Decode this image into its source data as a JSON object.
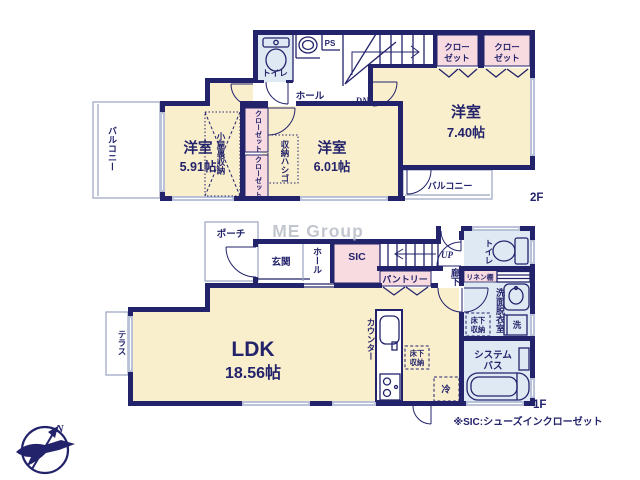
{
  "colors": {
    "wall_navy": "#23236b",
    "room_cream": "#faefcd",
    "wet_blue": "#dfe9f4",
    "closet_pink": "#f8dbe0",
    "window_gray": "#b9c2d8",
    "watermark_gray": "#b4b8c2"
  },
  "watermark": "ME Group",
  "note": "※SIC:シューズインクローゼット",
  "compass": {
    "n": "N"
  },
  "floors": {
    "f2": {
      "floor_label": "2F",
      "balcony_left": "バルコニー",
      "balcony_right": "バルコニー",
      "toilet": "トイレ",
      "ps": "PS",
      "hall": "ホール",
      "dn": "DN",
      "closet1_l1": "クロー",
      "closet1_l2": "ゼット",
      "closet2_l1": "クロー",
      "closet2_l2": "ゼット",
      "room740_name": "洋室",
      "room740_size": "7.40帖",
      "room591_name": "洋室",
      "room591_size": "5.91帖",
      "room601_name": "洋室",
      "room601_size": "6.01帖",
      "attic": "小屋裏収納",
      "closet_v1": "クローゼット",
      "closet_v2": "クローゼット",
      "ladder": "収納ハシゴ"
    },
    "f1": {
      "floor_label": "1F",
      "porch": "ポーチ",
      "entrance": "玄関",
      "hall": "ホール",
      "sic": "SIC",
      "pantry": "パントリー",
      "up": "UP",
      "corridor": "廊下",
      "toilet": "トイレ",
      "linen": "リネン棚",
      "washroom": "洗面脱衣室",
      "underfloor_wash_l1": "床下",
      "underfloor_wash_l2": "収納",
      "washer": "洗",
      "bath_l1": "システム",
      "bath_l2": "バス",
      "ldk_name": "LDK",
      "ldk_size": "18.56帖",
      "counter": "カウンター",
      "underfloor_kitchen_l1": "床下",
      "underfloor_kitchen_l2": "収納",
      "fridge": "冷",
      "terrace": "テラス"
    }
  }
}
